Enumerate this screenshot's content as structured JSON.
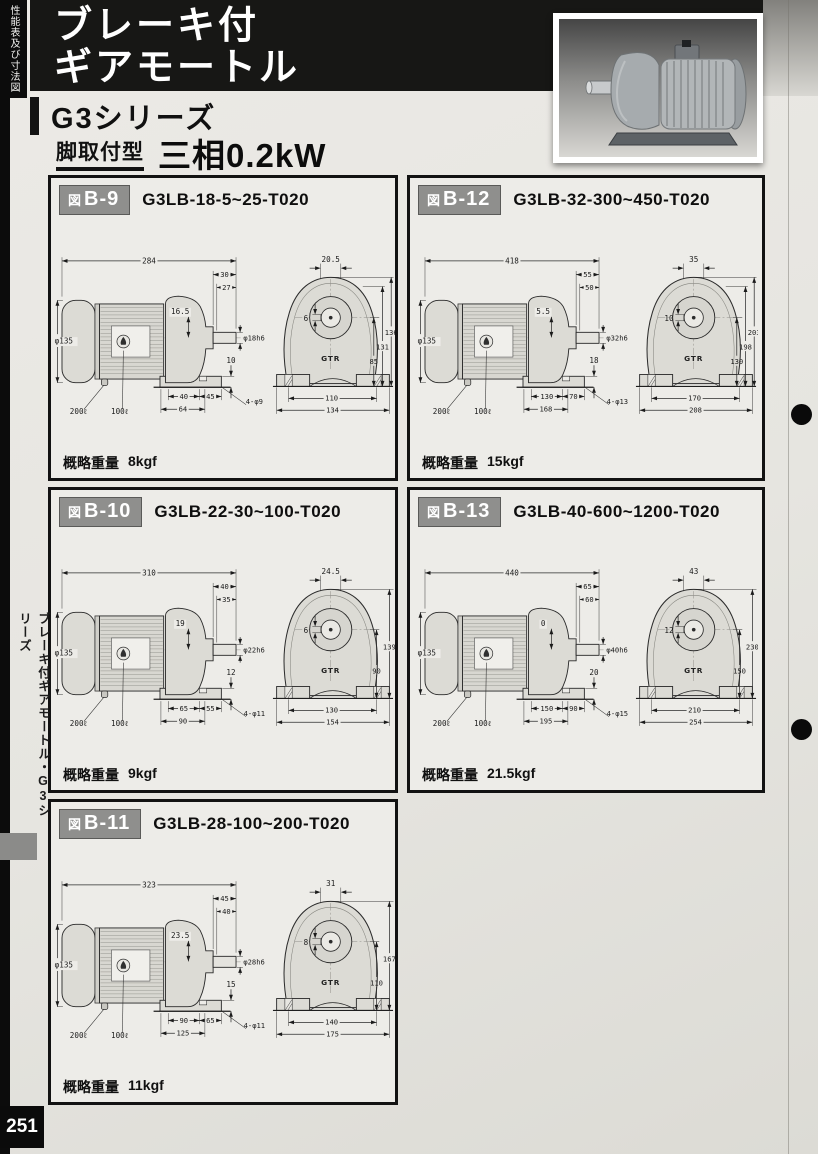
{
  "page": {
    "side_tab": "性能表及び寸法図",
    "banner_line1": "ブレーキ付",
    "banner_line2": "ギアモートル",
    "series": "G3シリーズ",
    "mount_type": "脚取付型",
    "power": "三相0.2kW",
    "sidebar_vertical": "ブレーキ付ギアモートル・G3シリーズ",
    "page_number": "251",
    "colors": {
      "banner_bg": "#171715",
      "badge_bg": "#8f8f8d",
      "paper": "#e8e7e3",
      "ink": "#111111"
    }
  },
  "panels": [
    {
      "fig_prefix": "図",
      "fig_code": "B-9",
      "model": "G3LB-18-5~25-T020",
      "weight_label": "概略重量",
      "weight_value": "8kgf",
      "side": {
        "overall": "284",
        "ext_a": "30",
        "ext_b": "27",
        "offset": "16.5",
        "motor_dia": "φ135",
        "shaft_dia": "φ18h6",
        "foot_h": "10",
        "lead_a": "200ℓ",
        "lead_b": "100ℓ",
        "f1": "40",
        "f2": "45",
        "f3": "64",
        "holes": "4-φ9"
      },
      "end": {
        "key_w": "20.5",
        "key_h": "6",
        "heights": [
          "136",
          "131",
          "85"
        ],
        "w1": "110",
        "w2": "134",
        "logo": "GTR"
      }
    },
    {
      "fig_prefix": "図",
      "fig_code": "B-12",
      "model": "G3LB-32-300~450-T020",
      "weight_label": "概略重量",
      "weight_value": "15kgf",
      "side": {
        "overall": "418",
        "ext_a": "55",
        "ext_b": "50",
        "offset": "5.5",
        "motor_dia": "φ135",
        "shaft_dia": "φ32h6",
        "foot_h": "18",
        "lead_a": "200ℓ",
        "lead_b": "100ℓ",
        "f1": "130",
        "f2": "70",
        "f3": "168",
        "holes": "4-φ13"
      },
      "end": {
        "key_w": "35",
        "key_h": "10",
        "heights": [
          "203",
          "198",
          "130"
        ],
        "w1": "170",
        "w2": "208",
        "logo": "GTR"
      }
    },
    {
      "fig_prefix": "図",
      "fig_code": "B-10",
      "model": "G3LB-22-30~100-T020",
      "weight_label": "概略重量",
      "weight_value": "9kgf",
      "side": {
        "overall": "310",
        "ext_a": "40",
        "ext_b": "35",
        "offset": "19",
        "motor_dia": "φ135",
        "shaft_dia": "φ22h6",
        "foot_h": "12",
        "lead_a": "200ℓ",
        "lead_b": "100ℓ",
        "f1": "65",
        "f2": "55",
        "f3": "90",
        "holes": "4-φ11"
      },
      "end": {
        "key_w": "24.5",
        "key_h": "6",
        "heights": [
          "139",
          "90"
        ],
        "w1": "130",
        "w2": "154",
        "logo": "GTR"
      }
    },
    {
      "fig_prefix": "図",
      "fig_code": "B-13",
      "model": "G3LB-40-600~1200-T020",
      "weight_label": "概略重量",
      "weight_value": "21.5kgf",
      "side": {
        "overall": "440",
        "ext_a": "65",
        "ext_b": "60",
        "offset": "0",
        "motor_dia": "φ135",
        "shaft_dia": "φ40h6",
        "foot_h": "20",
        "lead_a": "200ℓ",
        "lead_b": "100ℓ",
        "f1": "150",
        "f2": "90",
        "f3": "195",
        "holes": "4-φ15"
      },
      "end": {
        "key_w": "43",
        "key_h": "12",
        "heights": [
          "230",
          "150"
        ],
        "w1": "210",
        "w2": "254",
        "logo": "GTR"
      }
    },
    {
      "fig_prefix": "図",
      "fig_code": "B-11",
      "model": "G3LB-28-100~200-T020",
      "weight_label": "概略重量",
      "weight_value": "11kgf",
      "side": {
        "overall": "323",
        "ext_a": "45",
        "ext_b": "40",
        "offset": "23.5",
        "motor_dia": "φ135",
        "shaft_dia": "φ28h6",
        "foot_h": "15",
        "lead_a": "200ℓ",
        "lead_b": "100ℓ",
        "f1": "90",
        "f2": "65",
        "f3": "125",
        "holes": "4-φ11"
      },
      "end": {
        "key_w": "31",
        "key_h": "8",
        "heights": [
          "167",
          "110"
        ],
        "w1": "140",
        "w2": "175",
        "logo": "GTR"
      }
    }
  ]
}
